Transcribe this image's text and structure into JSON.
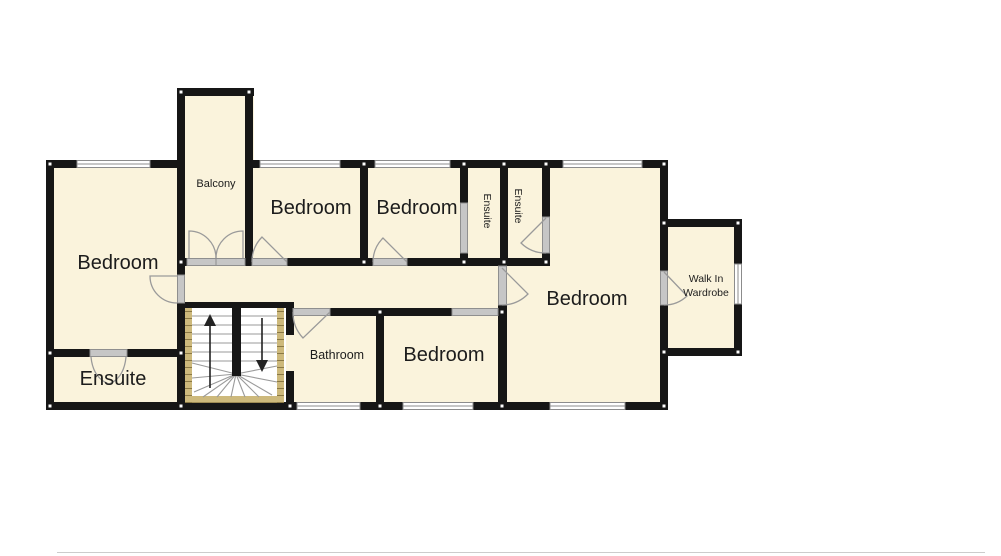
{
  "rooms": {
    "bedroom_left": "Bedroom",
    "ensuite_left": "Ensuite",
    "balcony": "Balcony",
    "bedroom_top_left": "Bedroom",
    "bedroom_top_right": "Bedroom",
    "ensuite_top_1": "Ensuite",
    "ensuite_top_2": "Ensuite",
    "bedroom_right": "Bedroom",
    "walk_in_wardrobe_line1": "Walk In",
    "walk_in_wardrobe_line2": "Wardrobe",
    "bathroom": "Bathroom",
    "bedroom_bottom": "Bedroom"
  },
  "colors": {
    "background": "#ffffff",
    "floor": "#faf3dc",
    "wall": "#161616",
    "window_fill": "#ffffff",
    "window_line": "#8c8c8c",
    "door_fill": "#c6c6c6",
    "door_edge": "#8f8f8f",
    "arc": "#9a9a9a",
    "stair_stringer": "#cdb97c",
    "stair_hatch": "#7e6d3a",
    "stair_tread": "#9a9a9a",
    "stair_divider": "#161616",
    "arrow": "#222222",
    "label": "#1c1c1c",
    "page_edge": "#cccccc"
  }
}
